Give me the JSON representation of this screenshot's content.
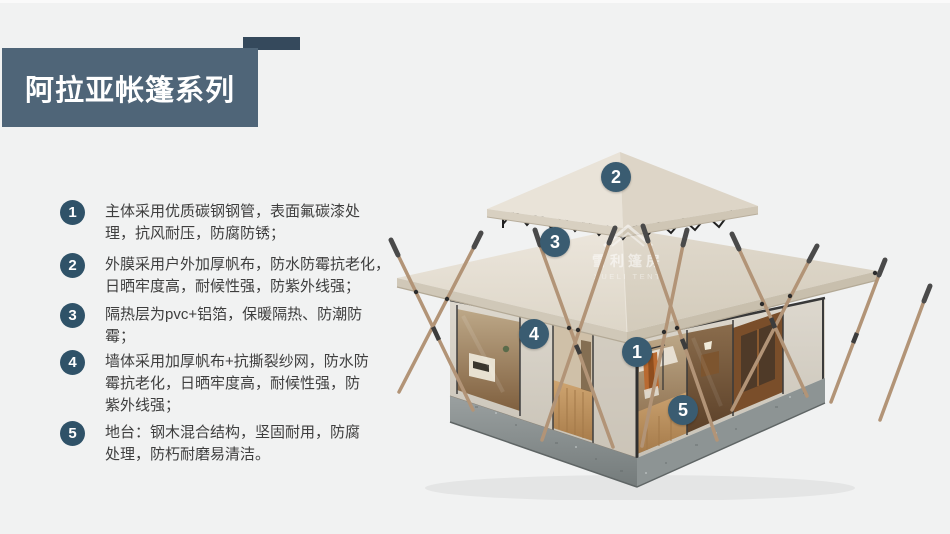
{
  "page": {
    "background": "#f1f2f2",
    "colors": {
      "title_bg": "#4f6578",
      "title_accent": "#35495c",
      "badge": "#2f5268",
      "marker": "#3a5c71",
      "roof_cream": "#e8e2d7",
      "canvas_wall": "#d8d3c9",
      "base_concrete": "#8f9696",
      "pole_wood": "#b29477",
      "floor_wood": "#c49a66"
    }
  },
  "header": {
    "title": "阿拉亚帐篷系列"
  },
  "features": {
    "items": [
      {
        "num": "1",
        "text": "主体采用优质碳钢钢管，表面氟碳漆处\n理，抗风耐压，防腐防锈；"
      },
      {
        "num": "2",
        "text": "外膜采用户外加厚帆布，防水防霉抗老化，\n日晒牢度高，耐候性强，防紫外线强；"
      },
      {
        "num": "3",
        "text": "隔热层为pvc+铝箔，保暖隔热、防潮防\n霉；"
      },
      {
        "num": "4",
        "text": "墙体采用加厚帆布+抗撕裂纱网，防水防\n霉抗老化，日晒牢度高，耐候性强，防\n紫外线强；"
      },
      {
        "num": "5",
        "text": "地台：钢木混合结构，坚固耐用，防腐\n处理，防朽耐磨易清洁。"
      }
    ]
  },
  "image": {
    "markers": [
      {
        "num": "1"
      },
      {
        "num": "2"
      },
      {
        "num": "3"
      },
      {
        "num": "4"
      },
      {
        "num": "5"
      }
    ],
    "watermark": {
      "cn": "雪利篷房",
      "en": "XUELI TENT"
    }
  }
}
